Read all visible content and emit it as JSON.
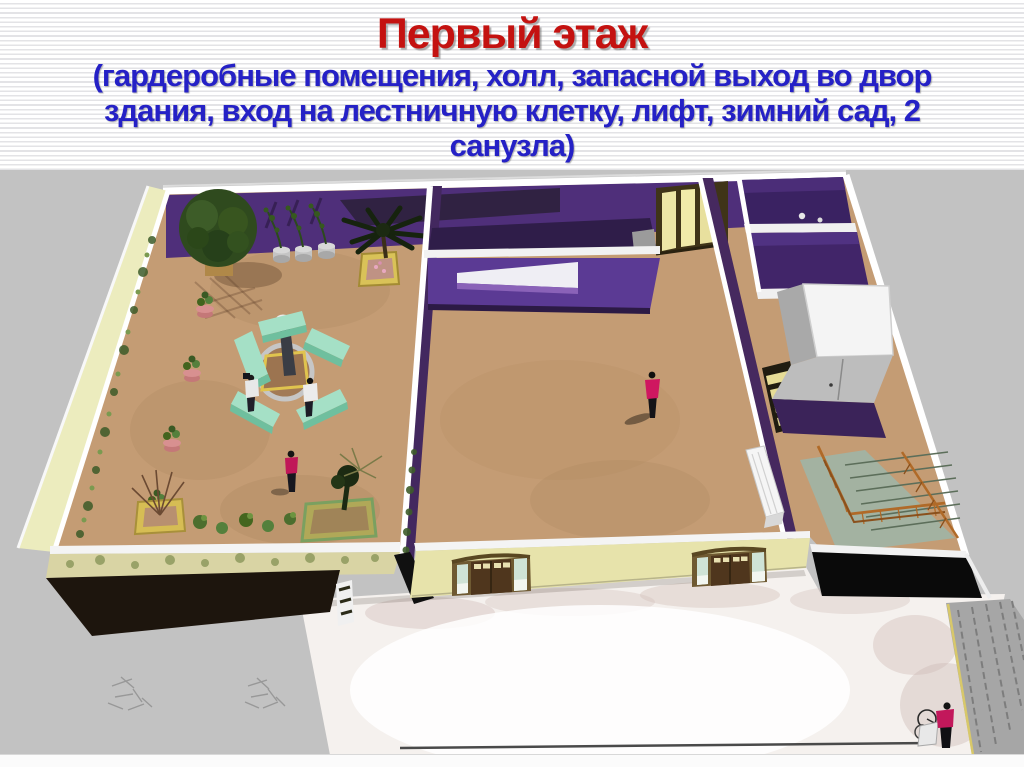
{
  "slide": {
    "title": "Первый этаж",
    "subtitle": "(гардеробные помещения, холл, запасной выход во двор здания, вход на лестничную клетку, лифт, зимний сад, 2 санузла)",
    "subtitle_lines": [
      "(гардеробные помещения, холл, запасной выход во двор",
      "здания, вход на лестничную клетку, лифт, зимний сад, 2",
      "санузла)"
    ]
  },
  "colors": {
    "title_red": "#c41210",
    "subtitle_blue": "#2521c6",
    "wall_purple": "#4f2f7a",
    "wall_purple_dark": "#35204f",
    "floor_tan": "#c49c74",
    "exterior_cream": "#e7e3ab",
    "pale_side_wall": "#ececbe",
    "bench_mint": "#a5e0c6",
    "railing_orange": "#b06a28",
    "marble_white": "#f5f1ee",
    "ground_gray": "#c2c2c2",
    "figure_magenta": "#c2185b"
  },
  "scene": {
    "elements": [
      "winter-garden",
      "hall",
      "reception-window-wall",
      "emergency-exit-door",
      "restroom-1",
      "restroom-2",
      "elevator",
      "staircase",
      "entrance-door-1",
      "entrance-door-2",
      "marble-walkway",
      "stone-fence",
      "tree",
      "palm-tree",
      "potted-plants",
      "bench-circle",
      "sitting-people",
      "walking-person",
      "standing-person",
      "cyclist"
    ]
  }
}
